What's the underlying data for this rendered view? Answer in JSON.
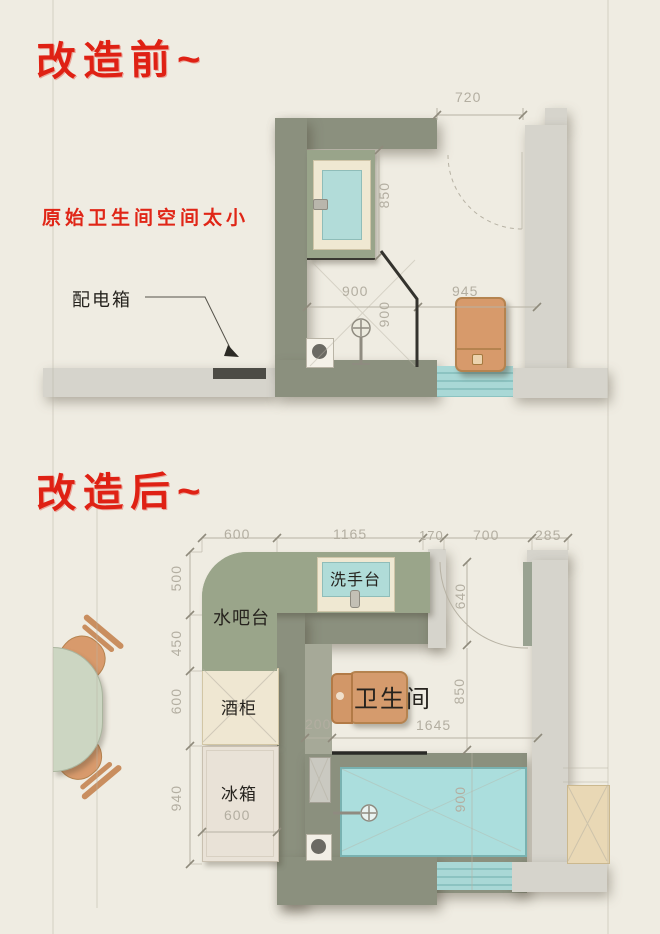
{
  "page": {
    "background_color": "#efece2",
    "accent_red": "#df2114",
    "wall_olive": "#8b907e",
    "wall_gray": "#d6d4cc",
    "counter_green": "#9aa58a",
    "water_teal": "#aadddd",
    "furniture_orange": "#d79a6b",
    "cabinet_cream": "#f0e8d3"
  },
  "before": {
    "title": "改造前~",
    "note": "原始卫生间空间太小",
    "distribution_box_label": "配电箱",
    "dims": {
      "door_width": "720",
      "basin_length": "850",
      "shower_width": "900",
      "shower_depth": "900",
      "right_width": "945"
    }
  },
  "after": {
    "title": "改造后~",
    "labels": {
      "water_bar": "水吧台",
      "washbasin": "洗手台",
      "wine_cabinet": "酒柜",
      "fridge": "冰箱",
      "bathroom": "卫生间"
    },
    "dims": {
      "top": [
        "600",
        "1165",
        "170",
        "700",
        "285"
      ],
      "left": [
        "500",
        "450",
        "600",
        "940"
      ],
      "door_height": "640",
      "toilet_wall": "850",
      "wall_return": "200",
      "bath_length": "1645",
      "bath_width": "900",
      "fridge_width": "600"
    }
  }
}
